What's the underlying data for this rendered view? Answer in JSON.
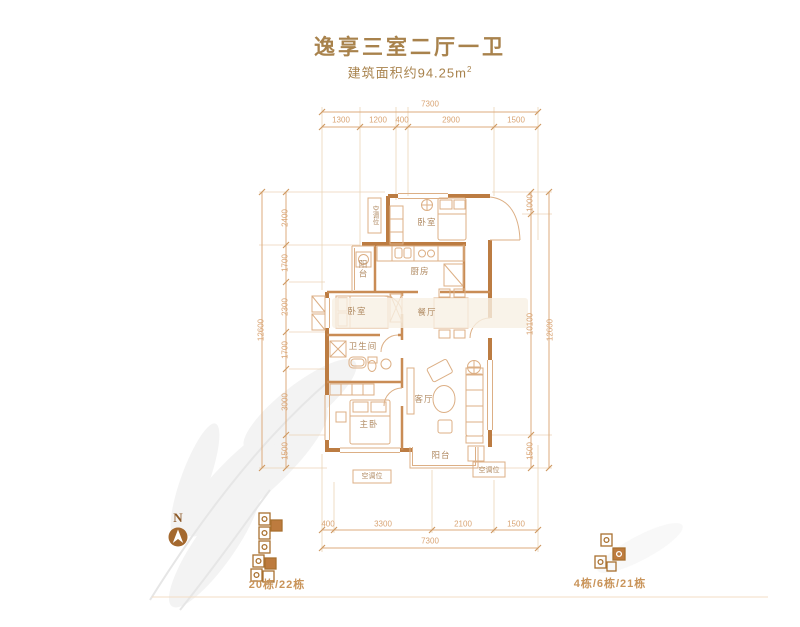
{
  "header": {
    "title": "逸享三室二厅一卫",
    "area_label": "建筑面积约94.25m",
    "area_sup": "2"
  },
  "dimensions": {
    "top": {
      "overall": "7300",
      "segments": [
        "1300",
        "1200",
        "400",
        "2900",
        "1500"
      ]
    },
    "bottom": {
      "overall": "7300",
      "segments": [
        "400",
        "3300",
        "2100",
        "1500"
      ]
    },
    "left": {
      "overall": "12600",
      "segments": [
        "2400",
        "1700",
        "2300",
        "1700",
        "3000",
        "1500"
      ]
    },
    "right": {
      "overall": "12600",
      "segments": [
        "1000",
        "10100",
        "1500"
      ]
    }
  },
  "rooms": {
    "bedroom_top": "卧室",
    "kitchen": "厨房",
    "kitchen_balcony": "阳台",
    "ac_top": "空调位",
    "bedroom_middle": "卧室",
    "dining": "餐厅",
    "bathroom": "卫生间",
    "living": "客厅",
    "master_bedroom": "主卧",
    "balcony": "阳台",
    "ac_bottom_left": "空调位",
    "ac_bottom_right": "空调位"
  },
  "legend": {
    "north": "N",
    "left_buildings": "20栋/22栋",
    "right_buildings": "4栋/6栋/21栋"
  },
  "colors": {
    "wall": "#bc7c42",
    "partition": "#c98c55",
    "thin_line": "#dcaf85",
    "dim_line": "#dcab7c",
    "dim_text": "#d9a474",
    "title_text": "#a8824c",
    "room_text": "#b08a62",
    "keyplan": "#a9702f"
  }
}
